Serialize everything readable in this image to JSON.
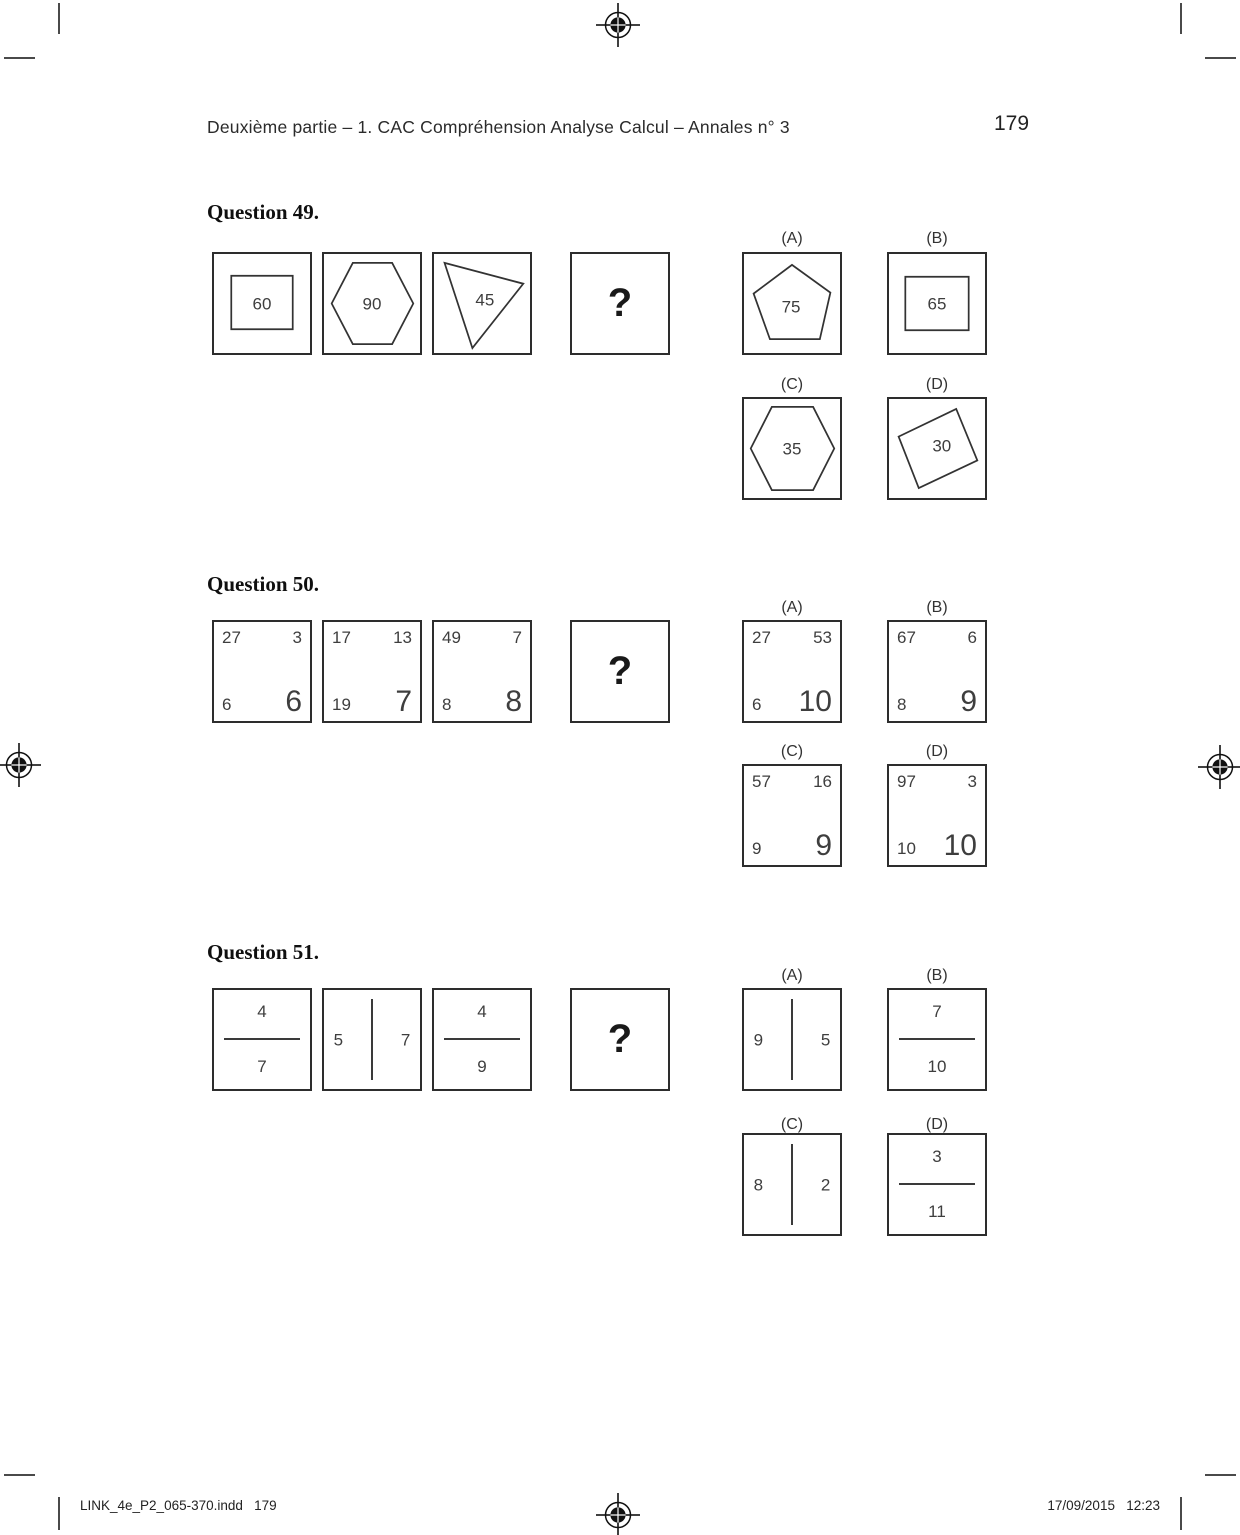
{
  "header": {
    "section_title": "Deuxième partie – 1. CAC Compréhension Analyse Calcul – Annales n° 3",
    "page_number": "179"
  },
  "footer": {
    "file_info": "LINK_4e_P2_065-370.indd   179",
    "datetime": "17/09/2015   12:23"
  },
  "print_marks": {
    "registration_icon": "registration-crosshair",
    "corner_icon": "crop-mark-line"
  },
  "questions": [
    {
      "title": "Question 49.",
      "sequence": [
        {
          "shape": "square-in-square",
          "value": "60"
        },
        {
          "shape": "hexagon",
          "value": "90"
        },
        {
          "shape": "triangle",
          "value": "45"
        },
        {
          "shape": "question-mark",
          "value": "?"
        }
      ],
      "options": [
        {
          "label": "(A)",
          "shape": "pentagon",
          "value": "75"
        },
        {
          "label": "(B)",
          "shape": "rectangle",
          "value": "65"
        },
        {
          "label": "(C)",
          "shape": "hexagon",
          "value": "35"
        },
        {
          "label": "(D)",
          "shape": "rotated-square",
          "value": "30"
        }
      ]
    },
    {
      "title": "Question 50.",
      "sequence": [
        {
          "shape": "corner-numbers",
          "tl": "27",
          "tr": "3",
          "bl": "6",
          "br": "6"
        },
        {
          "shape": "corner-numbers",
          "tl": "17",
          "tr": "13",
          "bl": "19",
          "br": "7"
        },
        {
          "shape": "corner-numbers",
          "tl": "49",
          "tr": "7",
          "bl": "8",
          "br": "8"
        },
        {
          "shape": "question-mark",
          "value": "?"
        }
      ],
      "options": [
        {
          "label": "(A)",
          "tl": "27",
          "tr": "53",
          "bl": "6",
          "br": "10"
        },
        {
          "label": "(B)",
          "tl": "67",
          "tr": "6",
          "bl": "8",
          "br": "9"
        },
        {
          "label": "(C)",
          "tl": "57",
          "tr": "16",
          "bl": "9",
          "br": "9"
        },
        {
          "label": "(D)",
          "tl": "97",
          "tr": "3",
          "bl": "10",
          "br": "10"
        }
      ]
    },
    {
      "title": "Question 51.",
      "sequence": [
        {
          "shape": "horizontal-bar",
          "first": "4",
          "second": "7"
        },
        {
          "shape": "vertical-bar",
          "first": "5",
          "second": "7"
        },
        {
          "shape": "horizontal-bar",
          "first": "4",
          "second": "9"
        },
        {
          "shape": "question-mark",
          "value": "?"
        }
      ],
      "options": [
        {
          "label": "(A)",
          "shape": "vertical-bar",
          "first": "9",
          "second": "5"
        },
        {
          "label": "(B)",
          "shape": "horizontal-bar",
          "first": "7",
          "second": "10"
        },
        {
          "label": "(C)",
          "shape": "vertical-bar",
          "first": "8",
          "second": "2"
        },
        {
          "label": "(D)",
          "shape": "horizontal-bar",
          "first": "3",
          "second": "11"
        }
      ]
    }
  ]
}
